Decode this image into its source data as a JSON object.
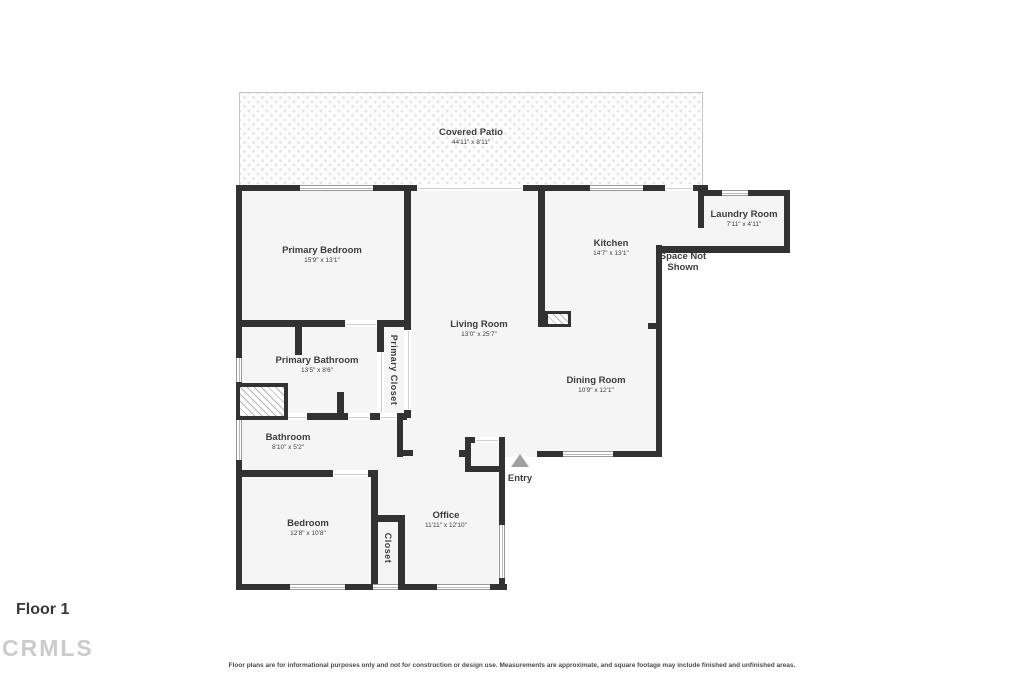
{
  "floor_label": "Floor 1",
  "watermark": "CRMLS",
  "disclaimer": "Floor plans are for informational purposes only and not for construction or design use. Measurements are approximate, and square footage may include finished and unfinished areas.",
  "rooms": {
    "covered_patio": {
      "name": "Covered Patio",
      "dims": "44'11\" x 8'11\""
    },
    "laundry": {
      "name": "Laundry Room",
      "dims": "7'11\" x 4'11\""
    },
    "primary_bedroom": {
      "name": "Primary Bedroom",
      "dims": "15'9\" x 13'1\""
    },
    "kitchen": {
      "name": "Kitchen",
      "dims": "14'7\" x 13'1\""
    },
    "space_not_shown": {
      "name": "Space Not Shown"
    },
    "living_room": {
      "name": "Living Room",
      "dims": "13'0\" x 25'7\""
    },
    "primary_bathroom": {
      "name": "Primary Bathroom",
      "dims": "13'5\" x 8'6\""
    },
    "primary_closet": {
      "name": "Primary Closet"
    },
    "dining_room": {
      "name": "Dining Room",
      "dims": "10'9\" x 12'1\""
    },
    "bathroom": {
      "name": "Bathroom",
      "dims": "8'10\" x 5'2\""
    },
    "bedroom": {
      "name": "Bedroom",
      "dims": "12'8\" x 10'8\""
    },
    "office": {
      "name": "Office",
      "dims": "11'11\" x 12'10\""
    },
    "closet": {
      "name": "Closet"
    },
    "entry": {
      "name": "Entry"
    }
  },
  "colors": {
    "wall": "#323232",
    "room_fill": "#f5f5f5",
    "label_text": "#3d3d3d",
    "entry_arrow": "#a0a0a0",
    "watermark_gray": "#cbcbcb"
  }
}
